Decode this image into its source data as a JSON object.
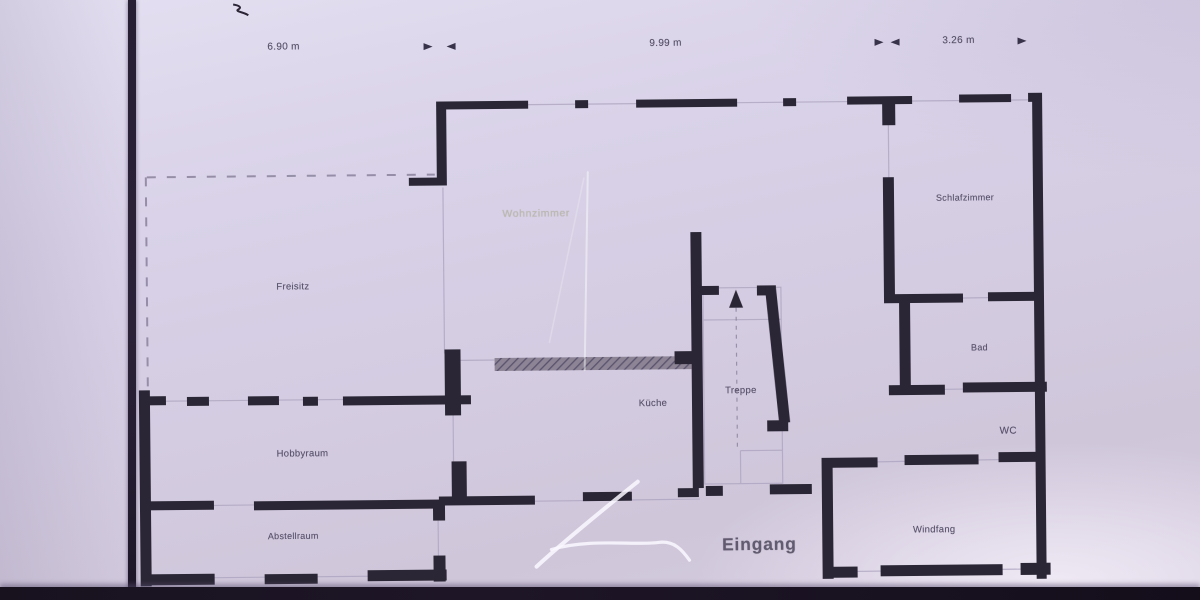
{
  "plan": {
    "dimensions": [
      {
        "label": "6.90 m"
      },
      {
        "label": "9.99 m"
      },
      {
        "label": "3.26 m"
      }
    ],
    "rooms": {
      "freisitz": "Freisitz",
      "wohnzimmer": "Wohnzimmer",
      "hobbyraum": "Hobbyraum",
      "abstellraum": "Abstellraum",
      "kueche": "Küche",
      "treppe": "Treppe",
      "schlafzimmer": "Schlafzimmer",
      "bad": "Bad",
      "wc": "WC",
      "windfang": "Windfang",
      "eingang": "Eingang"
    },
    "colors": {
      "paper": "#d8d1e7",
      "wall": "#2b2536",
      "ink": "#46405a",
      "pen_mark": "#f6f3fb",
      "faint_room_label": "#a3a878"
    }
  }
}
